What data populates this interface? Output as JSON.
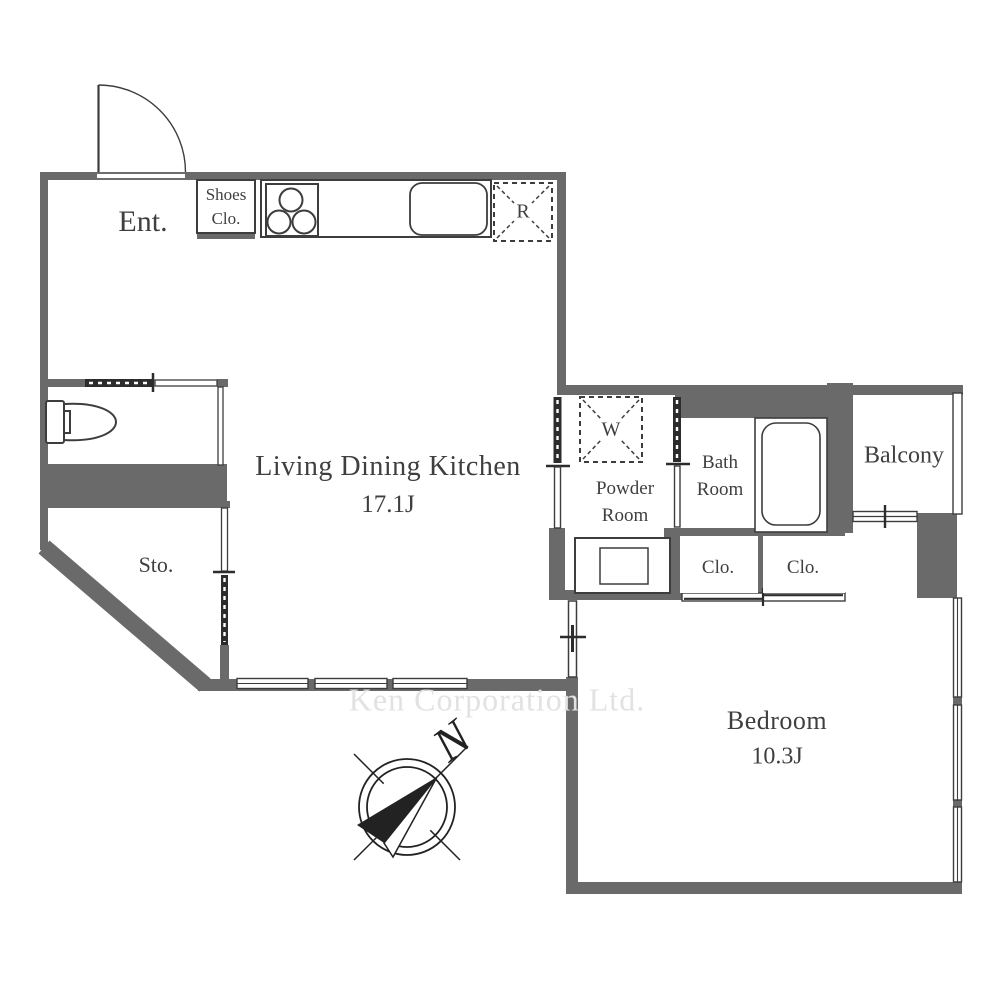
{
  "plan": {
    "rooms": {
      "entrance": {
        "label": "Ent."
      },
      "shoes_closet": {
        "line1": "Shoes",
        "line2": "Clo."
      },
      "ldk": {
        "label": "Living Dining Kitchen",
        "size": "17.1J"
      },
      "storage": {
        "label": "Sto."
      },
      "powder_room": {
        "line1": "Powder",
        "line2": "Room"
      },
      "bath_room": {
        "line1": "Bath",
        "line2": "Room"
      },
      "balcony": {
        "label": "Balcony"
      },
      "closet_left": {
        "label": "Clo."
      },
      "closet_right": {
        "label": "Clo."
      },
      "bedroom": {
        "label": "Bedroom",
        "size": "10.3J"
      }
    },
    "marks": {
      "refrigerator": "R",
      "washer": "W"
    },
    "compass": {
      "north": "N"
    },
    "watermark": {
      "text": "Ken Corporation Ltd."
    },
    "colors": {
      "wall": "#6a6a6a",
      "outline": "#3d3d3d",
      "text": "#3f3f3f",
      "watermark": "#e2e2e2"
    }
  }
}
